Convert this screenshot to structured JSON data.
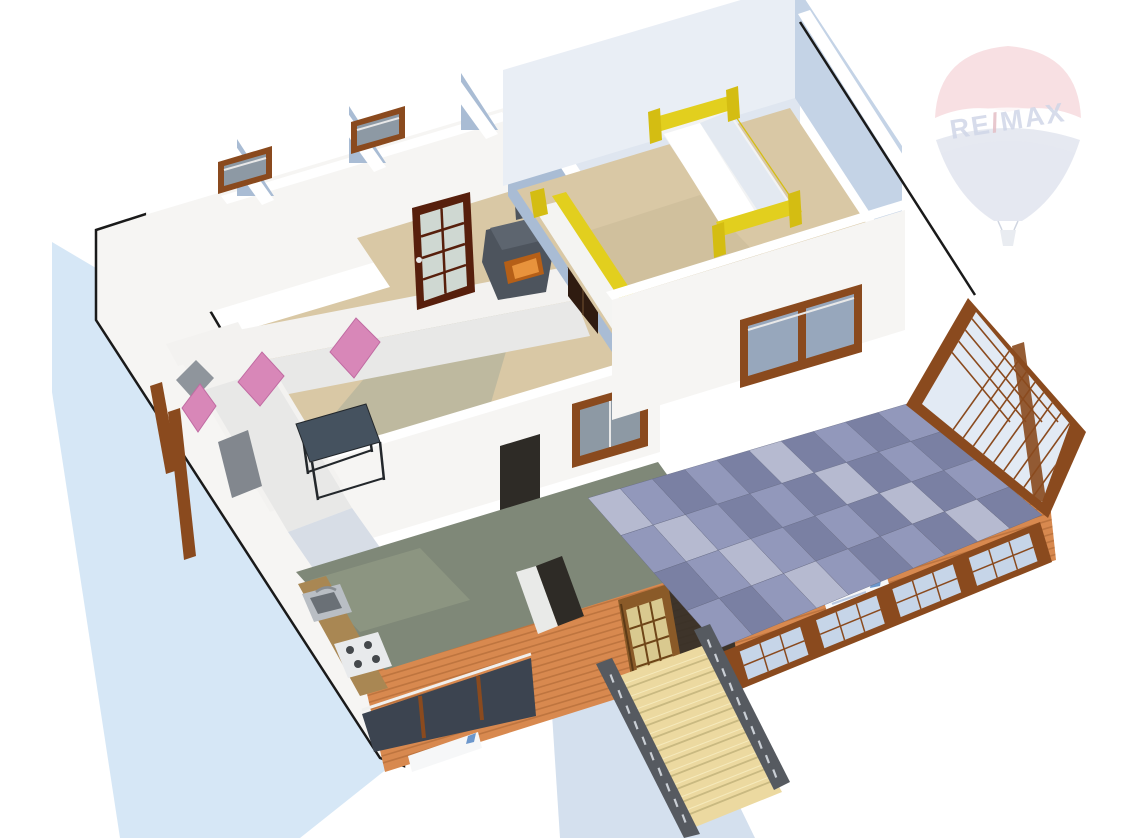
{
  "canvas": {
    "width": 1128,
    "height": 838,
    "background": "#ffffff"
  },
  "watermark": {
    "brand_re": "RE",
    "brand_slash": "/",
    "brand_max": "MAX",
    "text_color": "#a9b5d4",
    "slash_color": "#cf8b96",
    "balloon_red": "#e59099",
    "balloon_blue": "#a9b5cf",
    "basket_color": "#c5ccda",
    "opacity": 0.55
  },
  "palette": {
    "background": "#ffffff",
    "shadow_blue": "#cfe3f5",
    "ground_shadow": "#c9d8ea",
    "white_wall": "#f6f5f3",
    "wall_top": "#ffffff",
    "wall_tint": "#d9e2ef",
    "wall_shadow": "#a9bcd4",
    "wall_blue": "#c4d3e6",
    "wall_blue_light": "#e9eef5",
    "floor_tan": "#d9c8a5",
    "floor_shadow": "#a8ad9b",
    "floor_bed_shadow": "#c5b694",
    "floor_kitchen": "#7f8878",
    "floor_kitchen_light": "#97a089",
    "wood_frame": "#8a4a1e",
    "wood_dark_door": "#571f0c",
    "door_honey": "#8a5a28",
    "door_glass_warm": "#d9c98f",
    "glass_light": "#c6d5e8",
    "glass_pale": "#e2eaf4",
    "glass_dark": "#8d99a4",
    "glass_window_dark": "#3c4450",
    "glass_green": "#cfd8d2",
    "siding": "#d8894f",
    "siding_line": "#a96434",
    "yellow_bed": "#e2cf1e",
    "yellow_dark": "#d4bd12",
    "pink_pillow": "#d887b8",
    "pink_edge": "#c06ba2",
    "gray_pillow": "#8f959c",
    "gray_throw": "#82878e",
    "sofa_white": "#f3f2f0",
    "sofa_seat": "#e8e8e7",
    "sofa_shade": "#d7dde6",
    "sofa_front": "#bcc7d4",
    "table_top": "#45525f",
    "table_frame": "#23272b",
    "stove_body": "#4d545d",
    "stove_top": "#5d656f",
    "fire": "#b55f17",
    "fire_glow": "#e8933c",
    "stairs_wood": "#ecd9a0",
    "stairs_shadow": "#c9b981",
    "stairs_highlight": "#f8eec4",
    "rail_dark": "#565a60",
    "rail_slit": "#d7dce2",
    "roof_a": "#9298bb",
    "roof_b": "#7a80a3",
    "roof_c": "#b6bad0",
    "dark_opening": "#2e2b26",
    "sign_white": "#f6f7f8",
    "sign_mark": "#4a7ec0",
    "outline": "#1a1a1a",
    "counter_wood": "#a98753",
    "sink_metal": "#b9bec4",
    "sink_bowl": "#6a7076",
    "hob_white": "#e8eaec",
    "burner": "#44484c"
  },
  "scene": {
    "roof_tiles": {
      "cols": 10,
      "rows": 4
    },
    "siding_stripes": 14,
    "stairs_steps": 12,
    "conservatory_front_windows": 4,
    "rail_balusters": 10
  }
}
